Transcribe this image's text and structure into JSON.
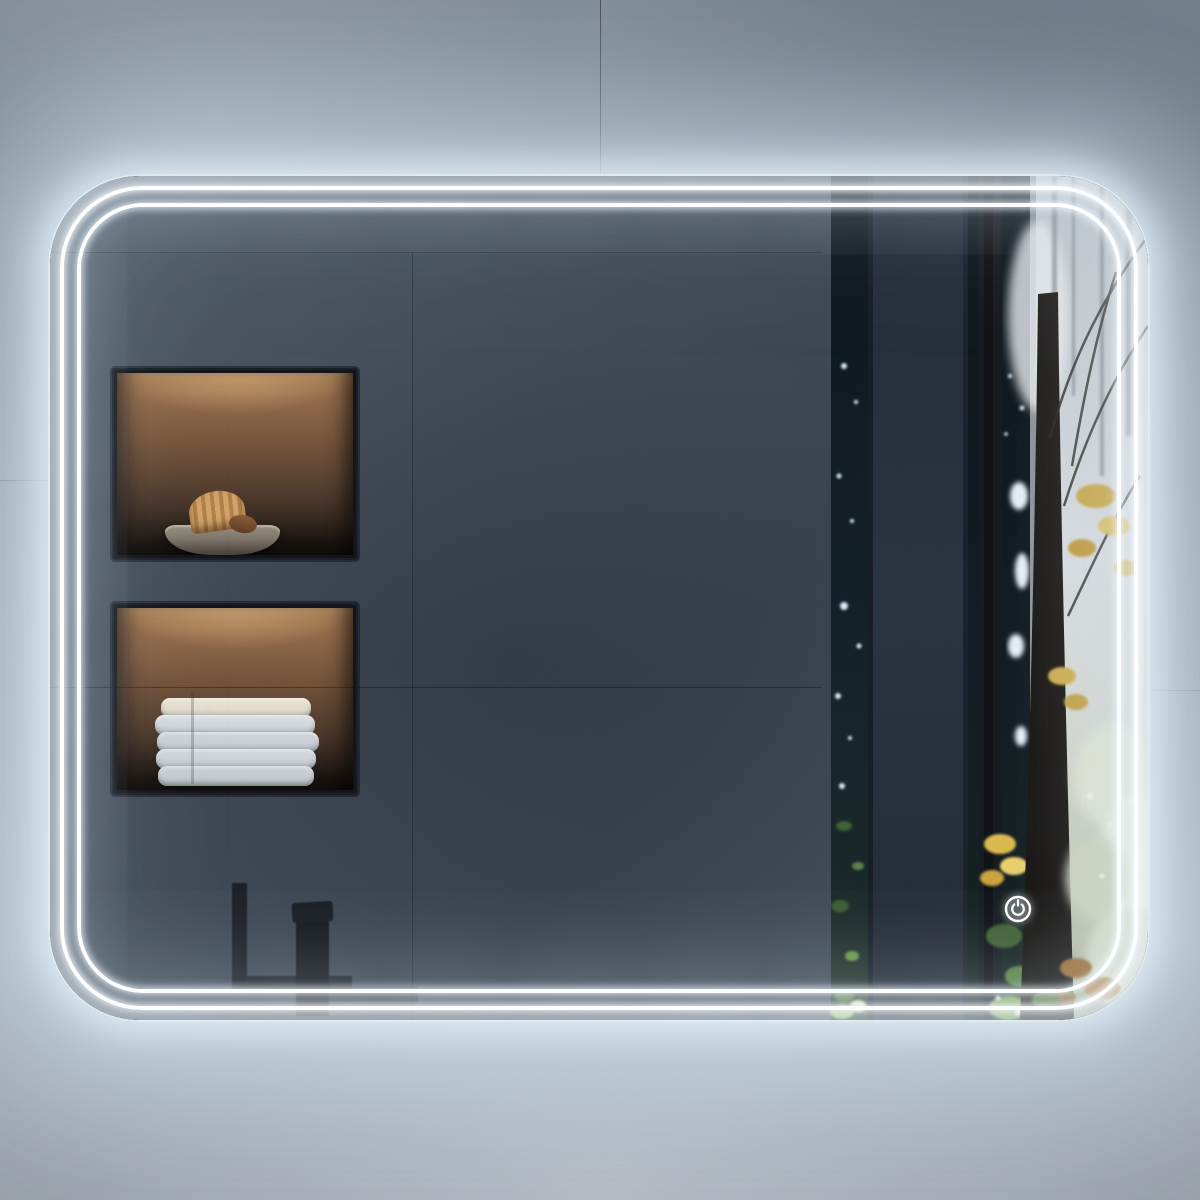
{
  "meta": {
    "image_type": "product-photo",
    "description": "Rectangular LED-backlit bathroom mirror with rounded corners and double interior light strips, mounted on a gray concrete tile wall; the glass reflects a dark concrete bathroom wall with two warm-lit recessed shelf niches, a black faucet silhouette and a misty autumn forest view"
  },
  "wall": {
    "material": "concrete tiles",
    "top_color": "#77818e",
    "bottom_color": "#a2aab4",
    "seams": [
      "vertical seam above mirror",
      "horizontal seam left of mirror",
      "horizontal seam right of mirror"
    ]
  },
  "mirror": {
    "shape": "rounded-rectangle",
    "corner_radius_px": 92,
    "led": {
      "state": "on",
      "strip_count": 2,
      "strip_color": "#fcfeff",
      "halo_color": "#d9e9f4"
    },
    "touch_control": {
      "icon": "power-icon",
      "color": "#ffffff",
      "location": "bottom-right of glass"
    }
  },
  "reflection": {
    "wall_color": "#3e4753",
    "niches": [
      {
        "name": "upper-shelf-niche",
        "lighting": "warm led from top",
        "light_color": "#e8b275",
        "contents": [
          "stone bowl",
          "dried botanical fan decor"
        ]
      },
      {
        "name": "lower-shelf-niche",
        "lighting": "warm led from top",
        "light_color": "#e8b275",
        "contents": [
          "stack of five folded white towels"
        ]
      }
    ],
    "fixtures": [
      {
        "name": "faucet-silhouette",
        "color": "#14181d"
      },
      {
        "name": "wall-pillar",
        "color": "#27303c"
      }
    ],
    "forest_view": {
      "elements": [
        "dark tree trunks",
        "mist",
        "autumn yellow leaves",
        "green undergrowth",
        "thin branches",
        "dry orange leaves"
      ],
      "colors": {
        "mist": "#d3d7da",
        "trunk": "#1d1a17",
        "autumn_leaves": "#c9a94c",
        "foliage_green": "#5b8044",
        "dry_leaves": "#a06c33"
      }
    }
  }
}
